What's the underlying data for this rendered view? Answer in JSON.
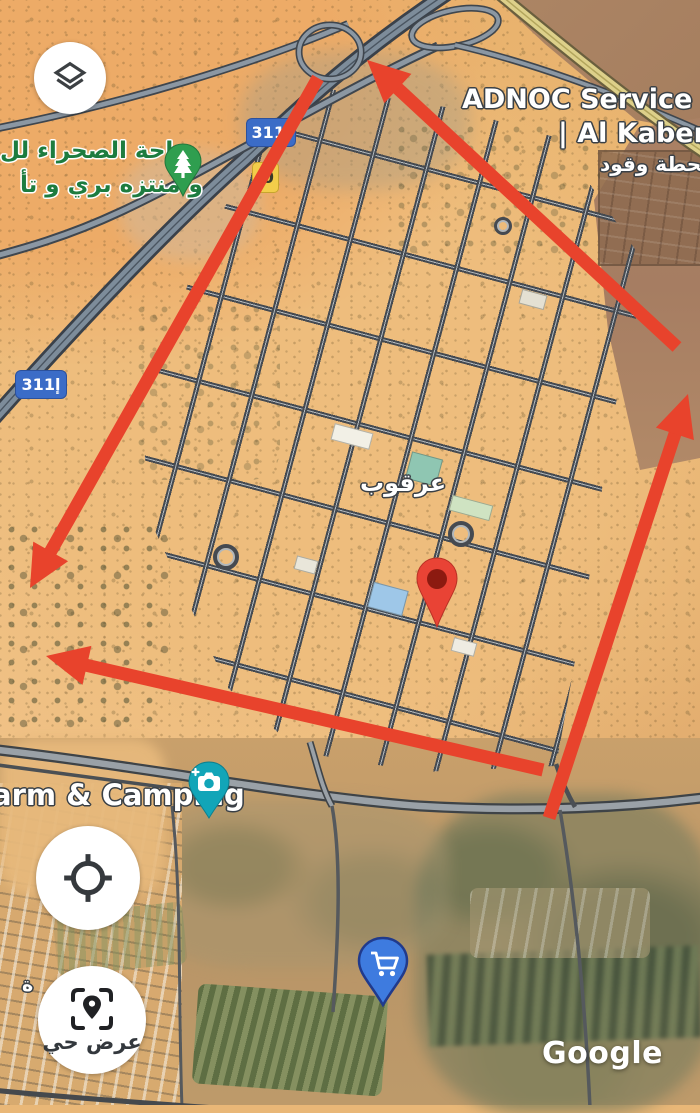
{
  "labels": {
    "oasis_line1": "واحة الصحراء لل",
    "oasis_line2": "و منتزه بري و تأ",
    "adnoc_line1": "ADNOC Service Sta",
    "adnoc_line2": "| Al Kaber (6",
    "adnoc_line3": "محطة وقود",
    "arqoub": "عرقوب",
    "camping": "arm & Camping",
    "edge_fragment": "ة",
    "watermark": "Google"
  },
  "shields": {
    "e311": "إ311",
    "yellow_badge": "0"
  },
  "controls": {
    "layers_button": {
      "icon": "layers-icon"
    },
    "my_location_button": {
      "icon": "my-location-icon"
    },
    "live_view_button": {
      "icon": "live-view-icon",
      "label": "عرض حي"
    }
  },
  "markers": {
    "red_pin": {
      "icon": "red-place-pin"
    },
    "tree_pin": {
      "icon": "park-tree-pin"
    },
    "camera_pin": {
      "icon": "photo-spot-pin"
    },
    "cart_pin": {
      "icon": "shopping-cart-pin"
    }
  },
  "colors": {
    "annotation_red": "#e8432c",
    "shield_blue": "#3b6cc7",
    "badge_yellow": "#f2cd4a",
    "pin_red": "#e94335",
    "pin_green": "#2f9e4f",
    "pin_teal": "#12a5b8",
    "pin_blue": "#3e7bdf",
    "label_green": "#1d7c3f"
  },
  "annotations": {
    "color": "#e8432c",
    "arrows": [
      {
        "tail": [
          677,
          347
        ],
        "tip": [
          367,
          60
        ]
      },
      {
        "tail": [
          549,
          818
        ],
        "tip": [
          688,
          394
        ]
      },
      {
        "tail": [
          318,
          78
        ],
        "tip": [
          30,
          588
        ]
      },
      {
        "tail": [
          543,
          770
        ],
        "tip": [
          46,
          656
        ]
      }
    ]
  }
}
